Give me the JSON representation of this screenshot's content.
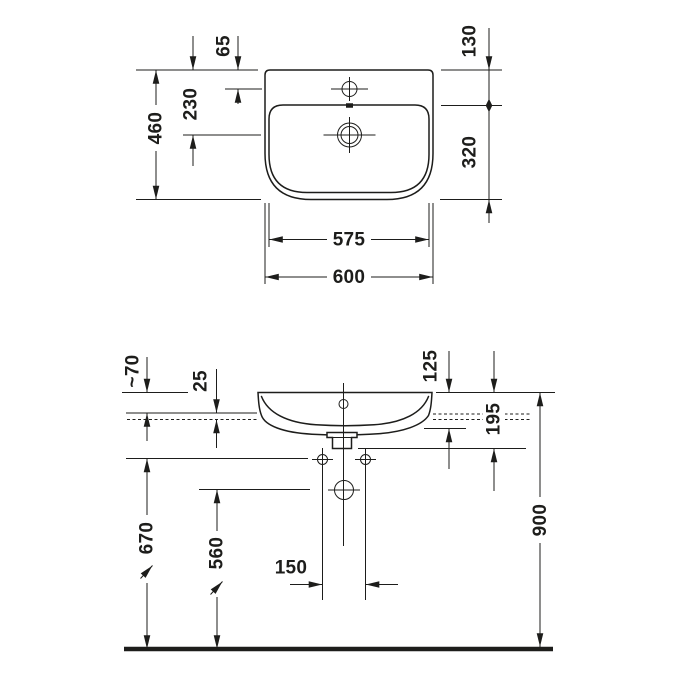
{
  "drawing": {
    "type": "washbasin technical dimension drawing",
    "line_color": "#1d1d1b",
    "background": "#ffffff"
  },
  "top_view": {
    "d460": "460",
    "d65": "65",
    "d230": "230",
    "d130": "130",
    "d320": "320",
    "d575": "575",
    "d600": "600"
  },
  "front_view": {
    "d70": "~70",
    "d25": "25",
    "d125": "125",
    "d195": "195",
    "d670": "670",
    "d560": "560",
    "d150": "150",
    "d900": "900"
  }
}
